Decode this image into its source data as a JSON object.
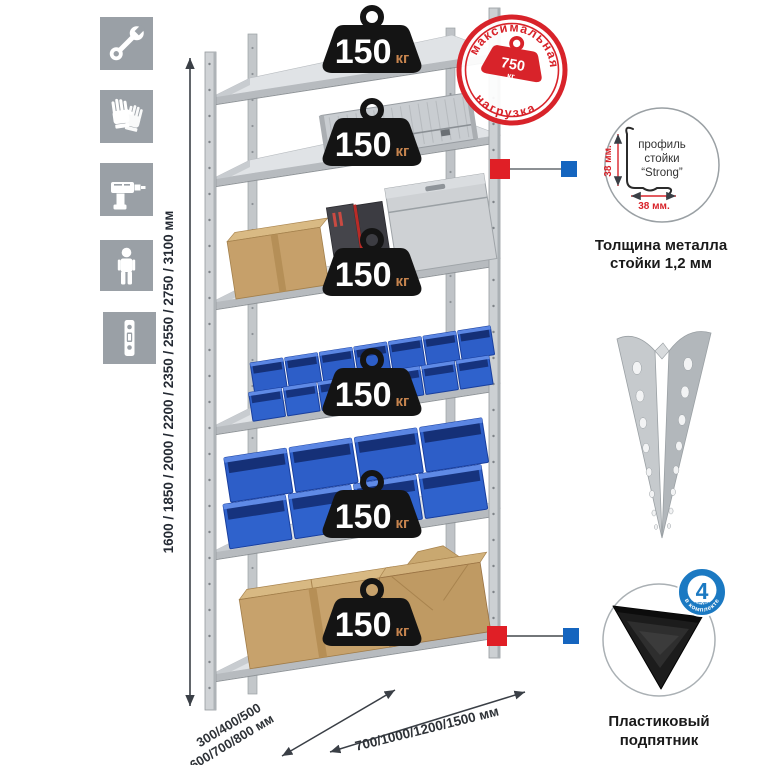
{
  "load_badge": {
    "value": "150",
    "unit": "кг"
  },
  "stamp": {
    "arc_top": "максимальная",
    "arc_bottom": "нагрузка",
    "weight_value": "750",
    "weight_unit": "кг"
  },
  "height_dim": "1600 / 1850 / 2000 / 2200 / 2350 / 2550 / 2750 / 3100 мм",
  "depth_dim": {
    "line1": "300/400/500",
    "line2": "600/700/800 мм"
  },
  "width_dim": "700/1000/1200/1500 мм",
  "profile_callout": {
    "label1": "профиль",
    "label2": "стойки",
    "label3": "“Strong”",
    "dim_v": "38 мм.",
    "dim_h": "38 мм.",
    "caption1": "Толщина металла",
    "caption2": "стойки 1,2 мм"
  },
  "foot_callout": {
    "badge_number": "4",
    "badge_word": "штуки",
    "badge_arc": "в комплекте",
    "caption1": "Пластиковый",
    "caption2": "подпятник"
  },
  "sidebar_icons": [
    "wrench-icon",
    "gloves-icon",
    "drill-icon",
    "person-icon",
    "profile-strip-icon"
  ],
  "colors": {
    "stamp_red": "#d8232a",
    "connector_red": "#e01f26",
    "connector_blue": "#1565bf",
    "badge_blue": "#1b79c2",
    "bin_blue": "#2d5ec8",
    "metal_gray": "#c7cbce",
    "sidebar_gray": "#9aa0a6",
    "weight_black": "#141414",
    "kg_orange": "#c8854f"
  }
}
